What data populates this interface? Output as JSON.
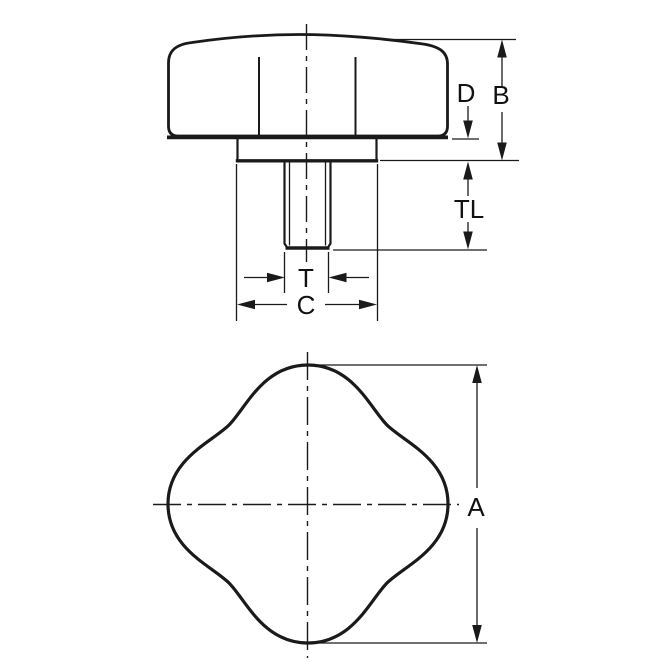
{
  "drawing": {
    "title": "Four-lobe knob engineering drawing, side view and front view",
    "background_color": "#ffffff",
    "line_color": "#1a1a1a",
    "label_color": "#111111",
    "side_view": {
      "description": "Side elevation of knob with flange and threaded stud",
      "dimension_labels": {
        "flange_thickness": "D",
        "overall_body_height": "B",
        "thread_length": "TL",
        "thread_diameter": "T",
        "hub_diameter": "C"
      }
    },
    "front_view": {
      "description": "Front view of four-lobe knob with centerlines",
      "dimension_labels": {
        "knob_diameter": "A"
      }
    }
  }
}
